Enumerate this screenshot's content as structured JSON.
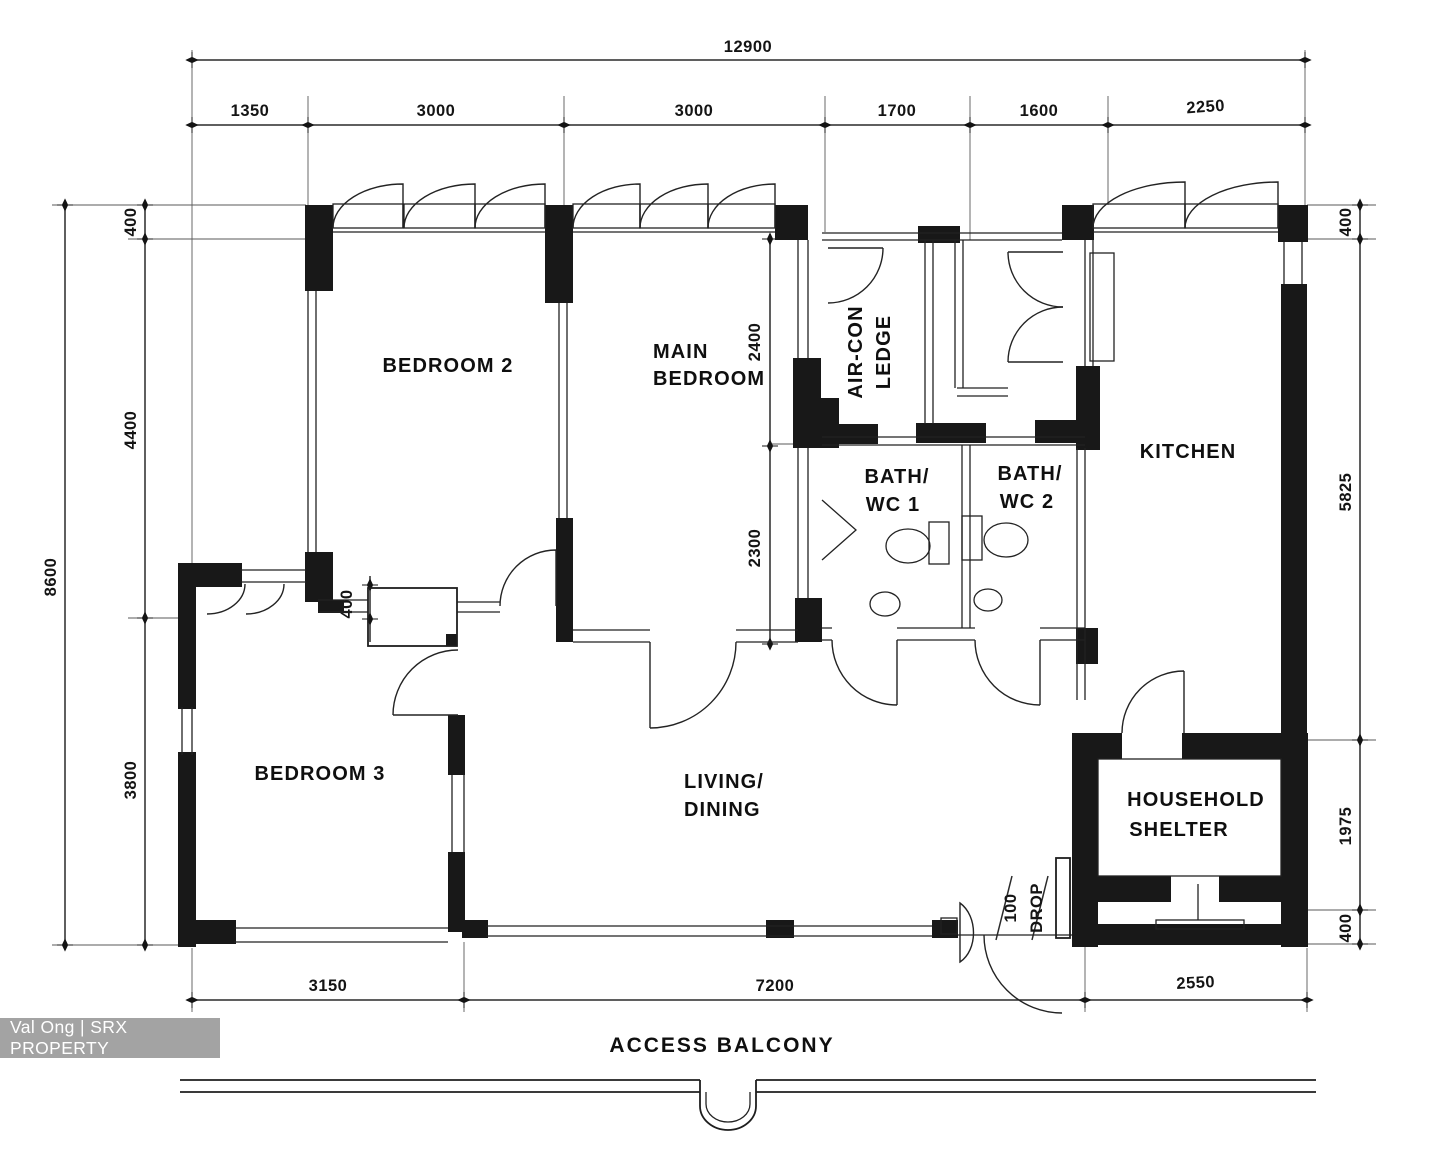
{
  "watermark": {
    "text": "Val Ong | SRX PROPERTY",
    "bg": "#969696",
    "fg": "#ffffff"
  },
  "colors": {
    "ink": "#1d1d1d",
    "wall": "#181818",
    "paper": "#ffffff"
  },
  "rooms": {
    "bedroom2": "BEDROOM 2",
    "main_bedroom_line1": "MAIN",
    "main_bedroom_line2": "BEDROOM",
    "aircon_line1": "AIR-CON",
    "aircon_line2": "LEDGE",
    "kitchen": "KITCHEN",
    "bath1_line1": "BATH/",
    "bath1_line2": "WC 1",
    "bath2_line1": "BATH/",
    "bath2_line2": "WC 2",
    "bedroom3": "BEDROOM 3",
    "living_line1": "LIVING/",
    "living_line2": "DINING",
    "shelter_line1": "HOUSEHOLD",
    "shelter_line2": "SHELTER",
    "access_balcony": "ACCESS BALCONY"
  },
  "dims": {
    "top_total": "12900",
    "top": [
      "1350",
      "3000",
      "3000",
      "1700",
      "1600",
      "2250"
    ],
    "left_total": "8600",
    "left": [
      "400",
      "4400",
      "3800"
    ],
    "right": [
      "400",
      "5825",
      "1975",
      "400"
    ],
    "bottom": [
      "3150",
      "7200",
      "2550"
    ],
    "interior": {
      "main_upper": "2400",
      "main_lower": "2300",
      "bed3": "400",
      "drop_line1": "100",
      "drop_line2": "DROP"
    }
  }
}
